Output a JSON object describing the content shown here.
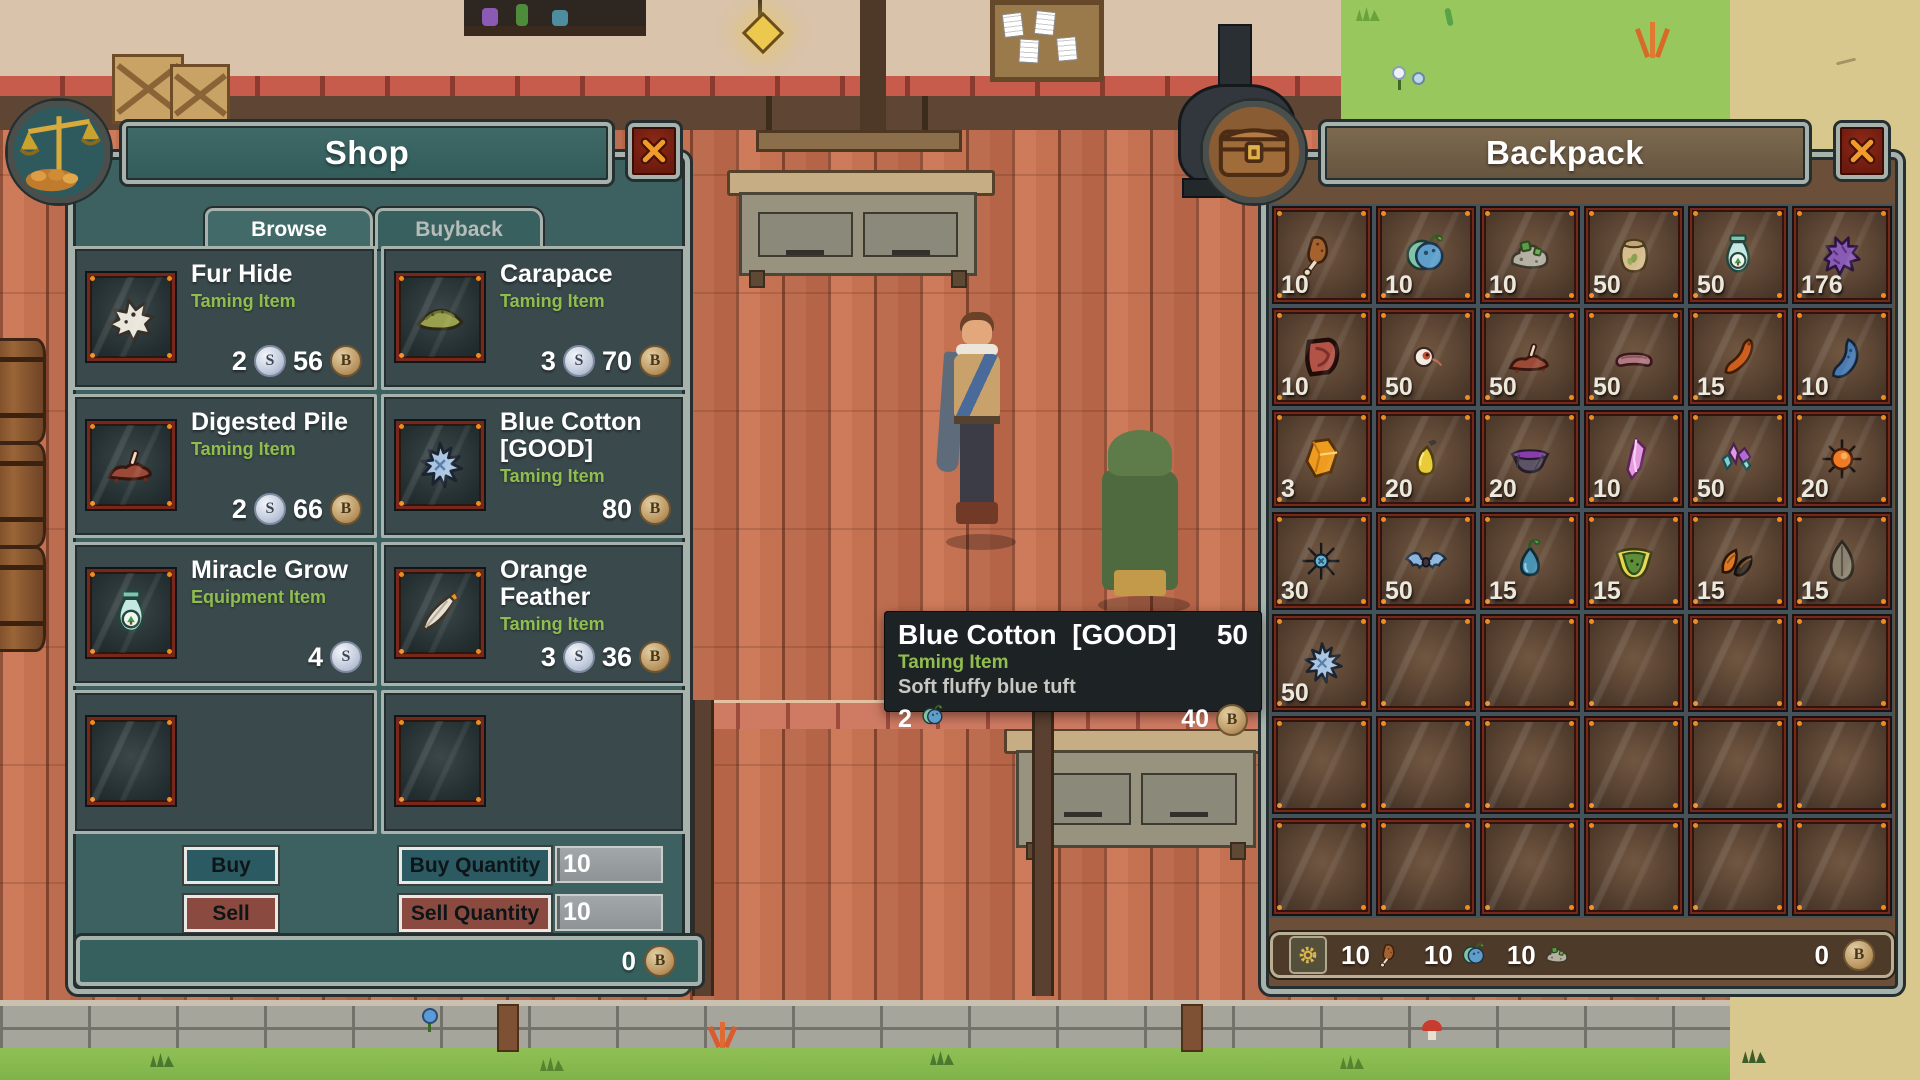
{
  "coins": {
    "silver": "S",
    "bronze": "B"
  },
  "shop": {
    "title": "Shop",
    "tabs": [
      {
        "label": "Browse",
        "active": true
      },
      {
        "label": "Buyback",
        "active": false
      }
    ],
    "items": [
      {
        "name": "Fur Hide",
        "type": "Taming Item",
        "icon": "fur-hide",
        "silver": "2",
        "bronze": "56"
      },
      {
        "name": "Carapace",
        "type": "Taming Item",
        "icon": "carapace",
        "silver": "3",
        "bronze": "70"
      },
      {
        "name": "Digested Pile",
        "type": "Taming Item",
        "icon": "digested-pile",
        "silver": "2",
        "bronze": "66"
      },
      {
        "name": "Blue Cotton [GOOD]",
        "type": "Taming Item",
        "icon": "blue-cotton",
        "silver": "",
        "bronze": "80"
      },
      {
        "name": "Miracle Grow",
        "type": "Equipment Item",
        "icon": "spray-bottle",
        "silver": "4",
        "bronze": ""
      },
      {
        "name": "Orange Feather",
        "type": "Taming Item",
        "icon": "orange-feather",
        "silver": "3",
        "bronze": "36"
      },
      null,
      null
    ],
    "buy_button": "Buy",
    "sell_button": "Sell",
    "buy_quantity_label": "Buy Quantity",
    "buy_quantity_value": "10",
    "sell_quantity_label": "Sell Quantity",
    "sell_quantity_value": "10",
    "wallet_bronze": "0"
  },
  "tooltip": {
    "title": "Blue Cotton  [GOOD]",
    "stack": "50",
    "type": "Taming Item",
    "description": "Soft fluffy blue tuft",
    "buy_cost": "2",
    "buy_cost_icon": "blue-fruit",
    "sell_value": "40"
  },
  "backpack": {
    "title": "Backpack",
    "columns": 6,
    "rows": 7,
    "slots": [
      {
        "icon": "meat-bone",
        "count": "10"
      },
      {
        "icon": "blue-fruit",
        "count": "10"
      },
      {
        "icon": "moss-rock",
        "count": "10"
      },
      {
        "icon": "seed-pouch",
        "count": "50"
      },
      {
        "icon": "spray-bottle",
        "count": "50"
      },
      {
        "icon": "purple-fluff",
        "count": "176"
      },
      {
        "icon": "red-meat",
        "count": "10"
      },
      {
        "icon": "eyeball",
        "count": "50"
      },
      {
        "icon": "digested-pile",
        "count": "50"
      },
      {
        "icon": "sausage",
        "count": "50"
      },
      {
        "icon": "orange-claw",
        "count": "15"
      },
      {
        "icon": "blue-claw",
        "count": "10"
      },
      {
        "icon": "orange-gem",
        "count": "3"
      },
      {
        "icon": "oil-flask",
        "count": "20"
      },
      {
        "icon": "purple-bowl",
        "count": "20"
      },
      {
        "icon": "pink-crystal",
        "count": "10"
      },
      {
        "icon": "crystal-cluster",
        "count": "50"
      },
      {
        "icon": "spiky-sun",
        "count": "20"
      },
      {
        "icon": "blue-burst",
        "count": "30"
      },
      {
        "icon": "bat",
        "count": "50"
      },
      {
        "icon": "water-sprout",
        "count": "15"
      },
      {
        "icon": "melon-slice",
        "count": "15"
      },
      {
        "icon": "seed-pods",
        "count": "15"
      },
      {
        "icon": "gray-leaf",
        "count": "15"
      },
      {
        "icon": "blue-cotton",
        "count": "50"
      },
      null,
      null,
      null,
      null,
      null,
      null,
      null,
      null,
      null,
      null,
      null,
      null,
      null,
      null,
      null,
      null,
      null
    ],
    "footer": {
      "resources": [
        {
          "icon": "meat-bone",
          "value": "10"
        },
        {
          "icon": "blue-fruit",
          "value": "10"
        },
        {
          "icon": "moss-rock",
          "value": "10"
        }
      ],
      "bronze": "0"
    }
  },
  "colors": {
    "panel_teal": "#3c6160",
    "panel_brown": "#6b4f38",
    "accent_green": "#8fbe4e",
    "slot_red": "#77281a",
    "corner_orange": "#ef8c1e"
  }
}
